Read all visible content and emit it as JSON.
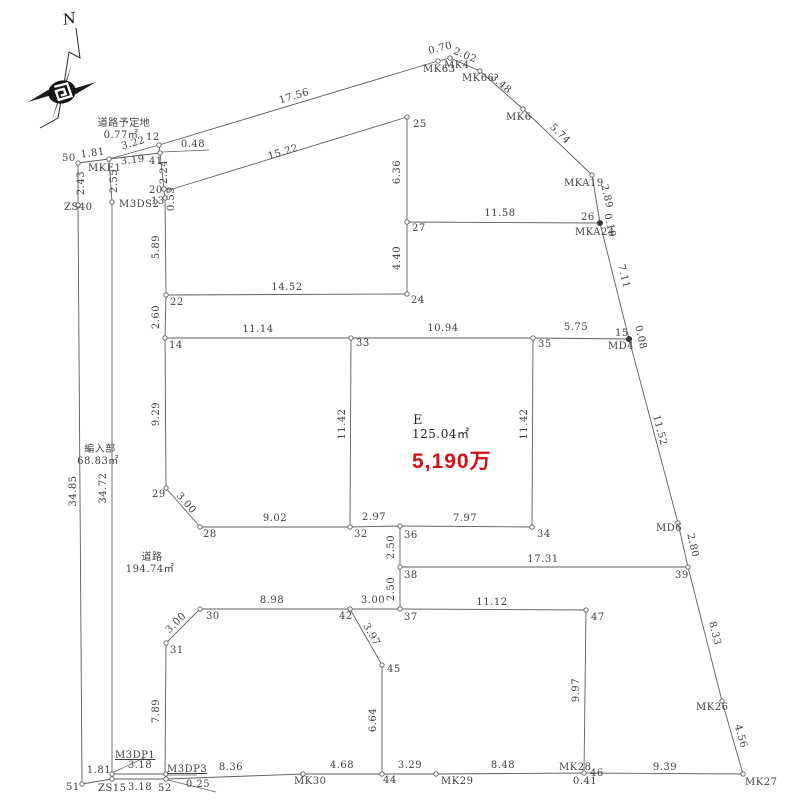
{
  "drawing": {
    "type": "cadastral-survey-plat",
    "background": "#ffffff",
    "line_color": "#5d5e60",
    "text_color": "#3f3f3f",
    "price_color": "#cd1318"
  },
  "compass": {
    "label": "N"
  },
  "parcel_e": {
    "name": "E",
    "area": "125.04㎡",
    "price": "5,190万"
  },
  "road_areas": [
    {
      "name": "道路予定地",
      "area": "0.77㎡"
    },
    {
      "name": "編入部",
      "area": "68.83㎡"
    },
    {
      "name": "道路",
      "area": "194.74㎡"
    }
  ],
  "survey": {
    "segments": [
      [
        78,
        163,
        109,
        159
      ],
      [
        109,
        159,
        159,
        145
      ],
      [
        109,
        159,
        160,
        153
      ],
      [
        159,
        145,
        160,
        153
      ],
      [
        159,
        145,
        438,
        61
      ],
      [
        438,
        61,
        450,
        58
      ],
      [
        450,
        58,
        480,
        71
      ],
      [
        480,
        71,
        523,
        109
      ],
      [
        523,
        109,
        592,
        175
      ],
      [
        592,
        175,
        600,
        223
      ],
      [
        600,
        223,
        629,
        339
      ],
      [
        629,
        339,
        678,
        523
      ],
      [
        678,
        523,
        688,
        567
      ],
      [
        688,
        567,
        722,
        701
      ],
      [
        722,
        701,
        743,
        774
      ],
      [
        78,
        163,
        78,
        205
      ],
      [
        78,
        205,
        82,
        784
      ],
      [
        109,
        159,
        112,
        202
      ],
      [
        112,
        202,
        112,
        779
      ],
      [
        160,
        153,
        164,
        189
      ],
      [
        164,
        189,
        165,
        198
      ],
      [
        165,
        198,
        166,
        295
      ],
      [
        169,
        190,
        407,
        117
      ],
      [
        407,
        117,
        407,
        222
      ],
      [
        407,
        222,
        600,
        223
      ],
      [
        407,
        222,
        407,
        294
      ],
      [
        166,
        295,
        407,
        294
      ],
      [
        166,
        295,
        165,
        338
      ],
      [
        165,
        338,
        351,
        338
      ],
      [
        351,
        338,
        533,
        338
      ],
      [
        533,
        338,
        629,
        339
      ],
      [
        351,
        338,
        350,
        527
      ],
      [
        533,
        338,
        532,
        527
      ],
      [
        165,
        338,
        166,
        488
      ],
      [
        166,
        488,
        200,
        527
      ],
      [
        200,
        527,
        350,
        527
      ],
      [
        350,
        527,
        400,
        526
      ],
      [
        400,
        526,
        532,
        527
      ],
      [
        400,
        526,
        400,
        567
      ],
      [
        400,
        567,
        688,
        567
      ],
      [
        400,
        567,
        400,
        609
      ],
      [
        200,
        609,
        350,
        609
      ],
      [
        350,
        609,
        400,
        609
      ],
      [
        400,
        609,
        586,
        610
      ],
      [
        200,
        609,
        166,
        643
      ],
      [
        166,
        643,
        165,
        774
      ],
      [
        350,
        609,
        382,
        665
      ],
      [
        382,
        665,
        382,
        774
      ],
      [
        586,
        610,
        584,
        773
      ],
      [
        82,
        784,
        112,
        779
      ],
      [
        112,
        779,
        166,
        779
      ],
      [
        112,
        774,
        166,
        774
      ],
      [
        166,
        779,
        303,
        774
      ],
      [
        303,
        774,
        382,
        774
      ],
      [
        382,
        774,
        436,
        774
      ],
      [
        436,
        774,
        584,
        773
      ],
      [
        584,
        773,
        743,
        774
      ]
    ],
    "leaders": [
      [
        162,
        152,
        209,
        150
      ],
      [
        146,
        757,
        112,
        773
      ],
      [
        166,
        775,
        197,
        775
      ],
      [
        168,
        780,
        216,
        792
      ]
    ],
    "vertices": [
      [
        78,
        163
      ],
      [
        109,
        159
      ],
      [
        159,
        145
      ],
      [
        160,
        153
      ],
      [
        78,
        205
      ],
      [
        112,
        202
      ],
      [
        164,
        189
      ],
      [
        165,
        198
      ],
      [
        169,
        190
      ],
      [
        166,
        295
      ],
      [
        165,
        338
      ],
      [
        407,
        294
      ],
      [
        407,
        222
      ],
      [
        407,
        117
      ],
      [
        438,
        61
      ],
      [
        450,
        58
      ],
      [
        480,
        71
      ],
      [
        523,
        109
      ],
      [
        592,
        175
      ],
      [
        351,
        338
      ],
      [
        533,
        338
      ],
      [
        350,
        527
      ],
      [
        400,
        526
      ],
      [
        532,
        527
      ],
      [
        166,
        488
      ],
      [
        200,
        527
      ],
      [
        678,
        523
      ],
      [
        688,
        567
      ],
      [
        400,
        567
      ],
      [
        400,
        609
      ],
      [
        350,
        609
      ],
      [
        200,
        609
      ],
      [
        166,
        643
      ],
      [
        382,
        665
      ],
      [
        586,
        610
      ],
      [
        382,
        774
      ],
      [
        303,
        774
      ],
      [
        436,
        774
      ],
      [
        584,
        773
      ],
      [
        722,
        701
      ],
      [
        743,
        774
      ],
      [
        82,
        784
      ],
      [
        112,
        779
      ],
      [
        166,
        779
      ],
      [
        112,
        774
      ],
      [
        166,
        774
      ]
    ],
    "filled_vertices": [
      [
        600,
        223
      ],
      [
        629,
        339
      ]
    ],
    "labels": [
      {
        "t": "道路予定地",
        "x": 124,
        "y": 126,
        "a": "m"
      },
      {
        "t": "0.77㎡",
        "x": 121,
        "y": 138,
        "a": "m"
      },
      {
        "t": "編入部",
        "x": 100,
        "y": 452,
        "a": "m"
      },
      {
        "t": "68.83㎡",
        "x": 98,
        "y": 464,
        "a": "m"
      },
      {
        "t": "道路",
        "x": 152,
        "y": 560,
        "a": "m"
      },
      {
        "t": "194.74㎡",
        "x": 150,
        "y": 572,
        "a": "m"
      },
      {
        "t": "E",
        "x": 413,
        "y": 424,
        "a": "s",
        "cls": "e1"
      },
      {
        "t": "125.04㎡",
        "x": 412,
        "y": 438,
        "a": "s",
        "cls": "e2"
      },
      {
        "t": "5,190万",
        "x": 412,
        "y": 468,
        "a": "s",
        "cls": "price"
      },
      {
        "t": "1.81",
        "x": 93,
        "y": 156,
        "a": "m",
        "r": -7
      },
      {
        "t": "3.22",
        "x": 134,
        "y": 146,
        "a": "m",
        "r": -16
      },
      {
        "t": "3.19",
        "x": 133,
        "y": 163,
        "a": "m",
        "r": -7
      },
      {
        "t": "0.48",
        "x": 193,
        "y": 147,
        "a": "m"
      },
      {
        "t": "17.56",
        "x": 295,
        "y": 99,
        "a": "m",
        "r": -17
      },
      {
        "t": "15.22",
        "x": 284,
        "y": 155,
        "a": "m",
        "r": -17
      },
      {
        "t": "11.58",
        "x": 500,
        "y": 216,
        "a": "m"
      },
      {
        "t": "14.52",
        "x": 287,
        "y": 290,
        "a": "m"
      },
      {
        "t": "11.14",
        "x": 258,
        "y": 332,
        "a": "m"
      },
      {
        "t": "10.94",
        "x": 443,
        "y": 331,
        "a": "m"
      },
      {
        "t": "5.75",
        "x": 576,
        "y": 330,
        "a": "m"
      },
      {
        "t": "9.02",
        "x": 275,
        "y": 521,
        "a": "m"
      },
      {
        "t": "2.97",
        "x": 374,
        "y": 520,
        "a": "m"
      },
      {
        "t": "7.97",
        "x": 465,
        "y": 521,
        "a": "m"
      },
      {
        "t": "17.31",
        "x": 543,
        "y": 562,
        "a": "m"
      },
      {
        "t": "8.98",
        "x": 272,
        "y": 603,
        "a": "m"
      },
      {
        "t": "3.00",
        "x": 373,
        "y": 603,
        "a": "m"
      },
      {
        "t": "11.12",
        "x": 492,
        "y": 605,
        "a": "m"
      },
      {
        "t": "1.81",
        "x": 99,
        "y": 773,
        "a": "m"
      },
      {
        "t": "3.18",
        "x": 140,
        "y": 768,
        "a": "m"
      },
      {
        "t": "3.18",
        "x": 140,
        "y": 790,
        "a": "m"
      },
      {
        "t": "0.25",
        "x": 198,
        "y": 787,
        "a": "m"
      },
      {
        "t": "8.36",
        "x": 231,
        "y": 770,
        "a": "m"
      },
      {
        "t": "4.68",
        "x": 342,
        "y": 768,
        "a": "m"
      },
      {
        "t": "3.29",
        "x": 410,
        "y": 768,
        "a": "m"
      },
      {
        "t": "8.48",
        "x": 503,
        "y": 768,
        "a": "m"
      },
      {
        "t": "9.39",
        "x": 665,
        "y": 770,
        "a": "m"
      },
      {
        "t": "0.41",
        "x": 585,
        "y": 784,
        "a": "m"
      },
      {
        "t": "2.43",
        "x": 84,
        "y": 183,
        "a": "m",
        "r": -90
      },
      {
        "t": "2.55",
        "x": 117,
        "y": 181,
        "a": "m",
        "r": -90
      },
      {
        "t": "2.24",
        "x": 167,
        "y": 172,
        "a": "m",
        "r": -90
      },
      {
        "t": "0.53",
        "x": 174,
        "y": 199,
        "a": "m",
        "r": -90
      },
      {
        "t": "5.89",
        "x": 159,
        "y": 247,
        "a": "m",
        "r": -90
      },
      {
        "t": "2.60",
        "x": 159,
        "y": 317,
        "a": "m",
        "r": -90
      },
      {
        "t": "9.29",
        "x": 159,
        "y": 414,
        "a": "m",
        "r": -90
      },
      {
        "t": "34.85",
        "x": 76,
        "y": 491,
        "a": "m",
        "r": -90
      },
      {
        "t": "34.72",
        "x": 106,
        "y": 488,
        "a": "m",
        "r": -90
      },
      {
        "t": "6.36",
        "x": 400,
        "y": 172,
        "a": "m",
        "r": -90
      },
      {
        "t": "4.40",
        "x": 400,
        "y": 258,
        "a": "m",
        "r": -90
      },
      {
        "t": "11.42",
        "x": 345,
        "y": 424,
        "a": "m",
        "r": -90
      },
      {
        "t": "11.42",
        "x": 527,
        "y": 424,
        "a": "m",
        "r": -90
      },
      {
        "t": "2.50",
        "x": 394,
        "y": 547,
        "a": "m",
        "r": -90
      },
      {
        "t": "2.50",
        "x": 394,
        "y": 589,
        "a": "m",
        "r": -90
      },
      {
        "t": "7.89",
        "x": 159,
        "y": 711,
        "a": "m",
        "r": -90
      },
      {
        "t": "6.64",
        "x": 376,
        "y": 720,
        "a": "m",
        "r": -90
      },
      {
        "t": "9.97",
        "x": 579,
        "y": 690,
        "a": "m",
        "r": -90
      },
      {
        "t": "0.70",
        "x": 441,
        "y": 51,
        "a": "m",
        "r": -14
      },
      {
        "t": "2.02",
        "x": 464,
        "y": 58,
        "a": "m",
        "r": 22
      },
      {
        "t": "3.48",
        "x": 499,
        "y": 86,
        "a": "m",
        "r": 41
      },
      {
        "t": "5.74",
        "x": 558,
        "y": 136,
        "a": "m",
        "r": 44
      },
      {
        "t": "2.89",
        "x": 604,
        "y": 197,
        "a": "m",
        "r": 77
      },
      {
        "t": "0.10",
        "x": 607,
        "y": 226,
        "a": "m",
        "r": 77
      },
      {
        "t": "7.11",
        "x": 621,
        "y": 277,
        "a": "m",
        "r": 76
      },
      {
        "t": "0.08",
        "x": 638,
        "y": 338,
        "a": "m",
        "r": 77
      },
      {
        "t": "11.52",
        "x": 657,
        "y": 431,
        "a": "m",
        "r": 75
      },
      {
        "t": "2.80",
        "x": 690,
        "y": 546,
        "a": "m",
        "r": 77
      },
      {
        "t": "8.33",
        "x": 712,
        "y": 634,
        "a": "m",
        "r": 76
      },
      {
        "t": "4.56",
        "x": 738,
        "y": 737,
        "a": "m",
        "r": 74
      },
      {
        "t": "3.00",
        "x": 184,
        "y": 505,
        "a": "m",
        "r": 49
      },
      {
        "t": "3.00",
        "x": 178,
        "y": 625,
        "a": "m",
        "r": -45
      },
      {
        "t": "3.97",
        "x": 369,
        "y": 636,
        "a": "m",
        "r": 60
      },
      {
        "t": "50",
        "x": 62,
        "y": 161,
        "a": "s"
      },
      {
        "t": "MKE1",
        "x": 88,
        "y": 171,
        "a": "s"
      },
      {
        "t": "12",
        "x": 146,
        "y": 140,
        "a": "s"
      },
      {
        "t": "41",
        "x": 149,
        "y": 164,
        "a": "s"
      },
      {
        "t": "ZS40",
        "x": 64,
        "y": 210,
        "a": "s"
      },
      {
        "t": "M3DS2",
        "x": 119,
        "y": 207,
        "a": "s"
      },
      {
        "t": "20",
        "x": 149,
        "y": 193,
        "a": "s"
      },
      {
        "t": "13",
        "x": 151,
        "y": 204,
        "a": "s"
      },
      {
        "t": "22",
        "x": 170,
        "y": 305,
        "a": "s"
      },
      {
        "t": "14",
        "x": 169,
        "y": 348,
        "a": "s"
      },
      {
        "t": "25",
        "x": 413,
        "y": 127,
        "a": "s"
      },
      {
        "t": "27",
        "x": 412,
        "y": 231,
        "a": "s"
      },
      {
        "t": "24",
        "x": 411,
        "y": 303,
        "a": "s"
      },
      {
        "t": "MK63",
        "x": 423,
        "y": 72,
        "a": "s"
      },
      {
        "t": "MK4",
        "x": 444,
        "y": 68,
        "a": "s"
      },
      {
        "t": "MK66",
        "x": 462,
        "y": 81,
        "a": "s"
      },
      {
        "t": "MK6",
        "x": 506,
        "y": 120,
        "a": "s"
      },
      {
        "t": "MKA19",
        "x": 564,
        "y": 186,
        "a": "s"
      },
      {
        "t": "26",
        "x": 581,
        "y": 220,
        "a": "s"
      },
      {
        "t": "MKA24",
        "x": 575,
        "y": 235,
        "a": "s"
      },
      {
        "t": "15",
        "x": 615,
        "y": 336,
        "a": "s"
      },
      {
        "t": "MD4",
        "x": 608,
        "y": 349,
        "a": "s"
      },
      {
        "t": "33",
        "x": 356,
        "y": 346,
        "a": "s"
      },
      {
        "t": "35",
        "x": 538,
        "y": 347,
        "a": "s"
      },
      {
        "t": "MD6",
        "x": 656,
        "y": 531,
        "a": "s"
      },
      {
        "t": "39",
        "x": 675,
        "y": 578,
        "a": "s"
      },
      {
        "t": "34",
        "x": 537,
        "y": 537,
        "a": "s"
      },
      {
        "t": "32",
        "x": 354,
        "y": 537,
        "a": "s"
      },
      {
        "t": "36",
        "x": 404,
        "y": 538,
        "a": "s"
      },
      {
        "t": "38",
        "x": 404,
        "y": 578,
        "a": "s"
      },
      {
        "t": "37",
        "x": 404,
        "y": 620,
        "a": "s"
      },
      {
        "t": "29",
        "x": 152,
        "y": 497,
        "a": "s"
      },
      {
        "t": "28",
        "x": 203,
        "y": 537,
        "a": "s"
      },
      {
        "t": "30",
        "x": 206,
        "y": 619,
        "a": "s"
      },
      {
        "t": "31",
        "x": 170,
        "y": 653,
        "a": "s"
      },
      {
        "t": "42",
        "x": 339,
        "y": 619,
        "a": "s"
      },
      {
        "t": "45",
        "x": 387,
        "y": 672,
        "a": "s"
      },
      {
        "t": "47",
        "x": 591,
        "y": 620,
        "a": "s"
      },
      {
        "t": "44",
        "x": 383,
        "y": 783,
        "a": "s"
      },
      {
        "t": "MK30",
        "x": 294,
        "y": 784,
        "a": "s"
      },
      {
        "t": "MK29",
        "x": 441,
        "y": 784,
        "a": "s"
      },
      {
        "t": "MK28",
        "x": 559,
        "y": 770,
        "a": "s"
      },
      {
        "t": "46",
        "x": 590,
        "y": 776,
        "a": "s"
      },
      {
        "t": "MK26",
        "x": 696,
        "y": 710,
        "a": "s"
      },
      {
        "t": "MK27",
        "x": 745,
        "y": 785,
        "a": "s"
      },
      {
        "t": "51",
        "x": 66,
        "y": 790,
        "a": "s"
      },
      {
        "t": "ZS15",
        "x": 98,
        "y": 791,
        "a": "s"
      },
      {
        "t": "52",
        "x": 158,
        "y": 791,
        "a": "s"
      },
      {
        "t": "M3DP1",
        "x": 115,
        "y": 758,
        "a": "s",
        "u": true
      },
      {
        "t": "M3DP3",
        "x": 167,
        "y": 772,
        "a": "s",
        "u": true
      }
    ]
  }
}
